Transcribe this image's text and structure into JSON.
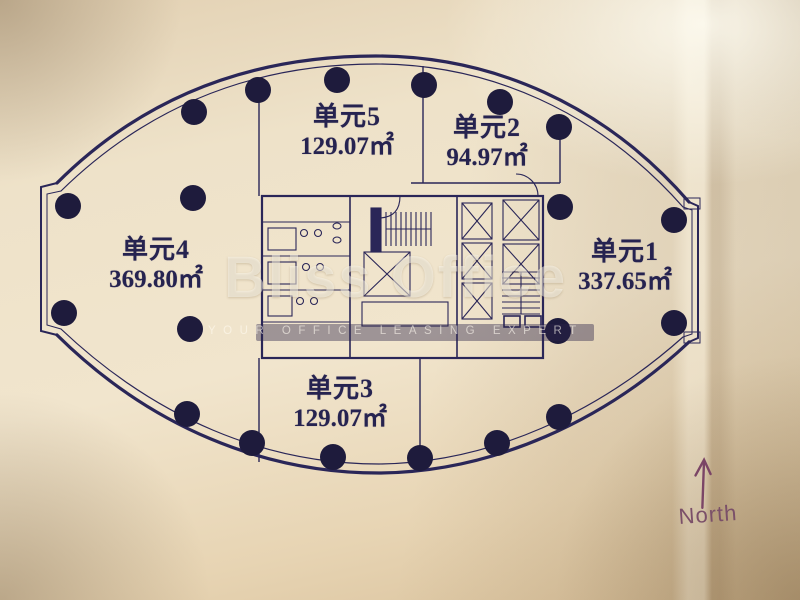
{
  "drawing_title": "elliptical office floor plan",
  "units": [
    {
      "id": "unit-1",
      "name": "单元1",
      "area": "337.65㎡"
    },
    {
      "id": "unit-2",
      "name": "单元2",
      "area": "94.97㎡"
    },
    {
      "id": "unit-3",
      "name": "单元3",
      "area": "129.07㎡"
    },
    {
      "id": "unit-4",
      "name": "单元4",
      "area": "369.80㎡"
    },
    {
      "id": "unit-5",
      "name": "单元5",
      "area": "129.07㎡"
    }
  ],
  "watermark": {
    "brand": "Bliss Office",
    "tagline": "YOUR OFFICE LEASING EXPERT"
  },
  "compass": {
    "label": "North"
  },
  "colors": {
    "paper": "#eee2c9",
    "plan_line": "#2a2658",
    "column_dot": "#1e1b3c",
    "label_text": "#262350",
    "compass": "#7b5069",
    "watermark_text": "#fffcf4"
  }
}
